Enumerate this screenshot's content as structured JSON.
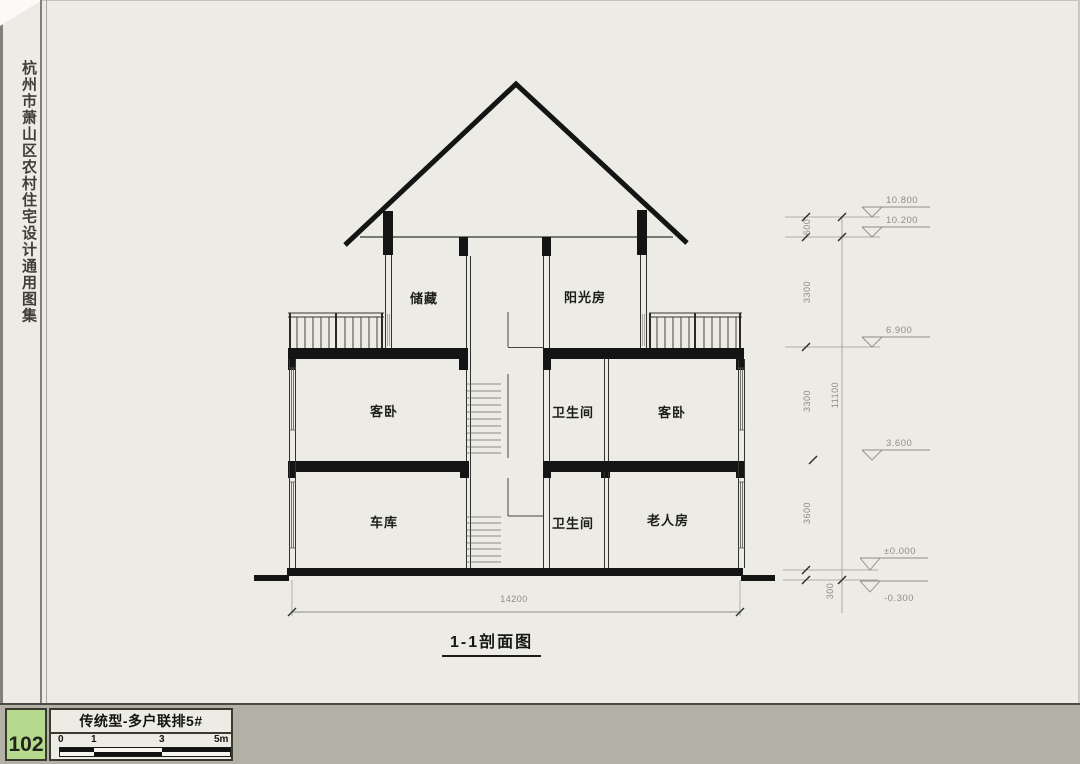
{
  "page": {
    "sidebar_title": "杭州市萧山区农村住宅设计通用图集"
  },
  "section": {
    "title": "1-1剖面图",
    "rooms": {
      "attic_left": "储藏",
      "attic_right": "阳光房",
      "second_floor_left": "客卧",
      "second_floor_middle": "卫生间",
      "second_floor_right": "客卧",
      "first_floor_left": "车库",
      "first_floor_middle": "卫生间",
      "first_floor_right": "老人房"
    },
    "elevations": {
      "ridge": "10.800",
      "eave": "10.200",
      "attic_floor": "6.900",
      "second_floor": "3.600",
      "ground_floor": "±0.000",
      "site": "-0.300"
    },
    "dimensions": {
      "overall_width": "14200",
      "overall_height": "11100",
      "parapet": "600",
      "attic_story": "3300",
      "second_story": "3300",
      "first_story": "3600",
      "plinth": "300"
    }
  },
  "footer": {
    "page_number": "102",
    "drawing_title": "传统型-多户联排5#",
    "scale_labels": [
      "0",
      "1",
      "3",
      "5m"
    ]
  },
  "colors": {
    "page_background": "#edebe6",
    "footer_band": "#b2b1a5",
    "page_number_green": "#b5d98d",
    "line_black": "#141414",
    "dim_gray": "#8d8c85"
  }
}
